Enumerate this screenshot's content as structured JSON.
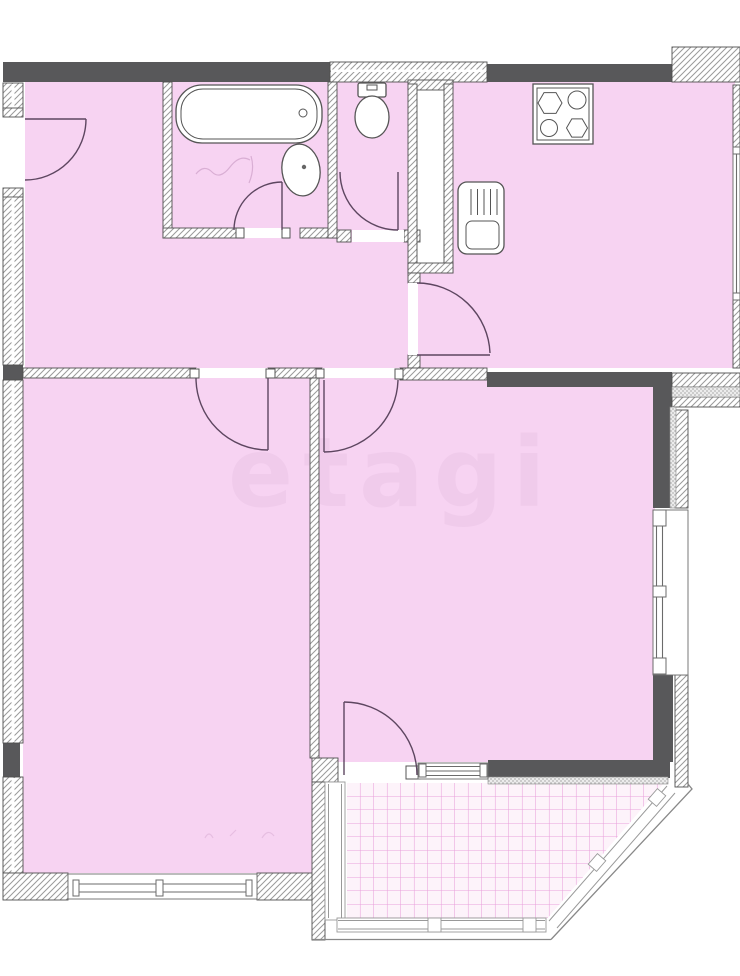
{
  "meta": {
    "title": "Apartment floor plan drawing",
    "type": "architectural-floor-plan"
  },
  "watermark": {
    "text": "etagi"
  },
  "palette": {
    "background": "#ffffff",
    "floor_pink": "#f7d3f2",
    "wall_dark": "#58585a",
    "wall_hatch_line": "#9a9a9a",
    "wall_outline": "#4f4f4f",
    "door_arc": "#5d4660",
    "window_frame": "#6b6b6b",
    "tile_line": "#d85ac2",
    "tile_floor": "#fdf3fa",
    "glazing_line": "#999999",
    "watermark_color": "#8a568a"
  },
  "rooms": [
    {
      "name": "hall",
      "note": "entry hall with entrance door on left wall"
    },
    {
      "name": "bathroom",
      "note": "bathtub and oval wash basin"
    },
    {
      "name": "toilet",
      "note": "WC with cistern against top wall"
    },
    {
      "name": "duct-shaft",
      "note": "white ventilation shaft between toilet and kitchen"
    },
    {
      "name": "kitchen",
      "note": "stove at top wall, sink unit at left wall"
    },
    {
      "name": "room-left",
      "note": "bottom-left room with window in bottom wall"
    },
    {
      "name": "room-living",
      "note": "bottom-right room with right-side window and balcony exit"
    },
    {
      "name": "balcony",
      "note": "glazed loggia with tiled floor and chamfered corner"
    }
  ],
  "fixtures": [
    {
      "name": "bathtub-icon"
    },
    {
      "name": "wash-basin-icon"
    },
    {
      "name": "toilet-icon"
    },
    {
      "name": "stove-4-burner-icon"
    },
    {
      "name": "kitchen-sink-unit-icon"
    }
  ],
  "doors": [
    {
      "name": "entrance-door"
    },
    {
      "name": "bathroom-door"
    },
    {
      "name": "toilet-door"
    },
    {
      "name": "kitchen-door"
    },
    {
      "name": "room-left-door"
    },
    {
      "name": "room-living-door"
    },
    {
      "name": "balcony-door"
    }
  ],
  "windows": [
    {
      "name": "window-room-left-bottom"
    },
    {
      "name": "window-room-living-right"
    },
    {
      "name": "window-beside-balcony-door"
    },
    {
      "name": "window-kitchen-right-edge"
    }
  ],
  "balcony": {
    "tile_grid_px": 13.5,
    "posts": 4
  }
}
